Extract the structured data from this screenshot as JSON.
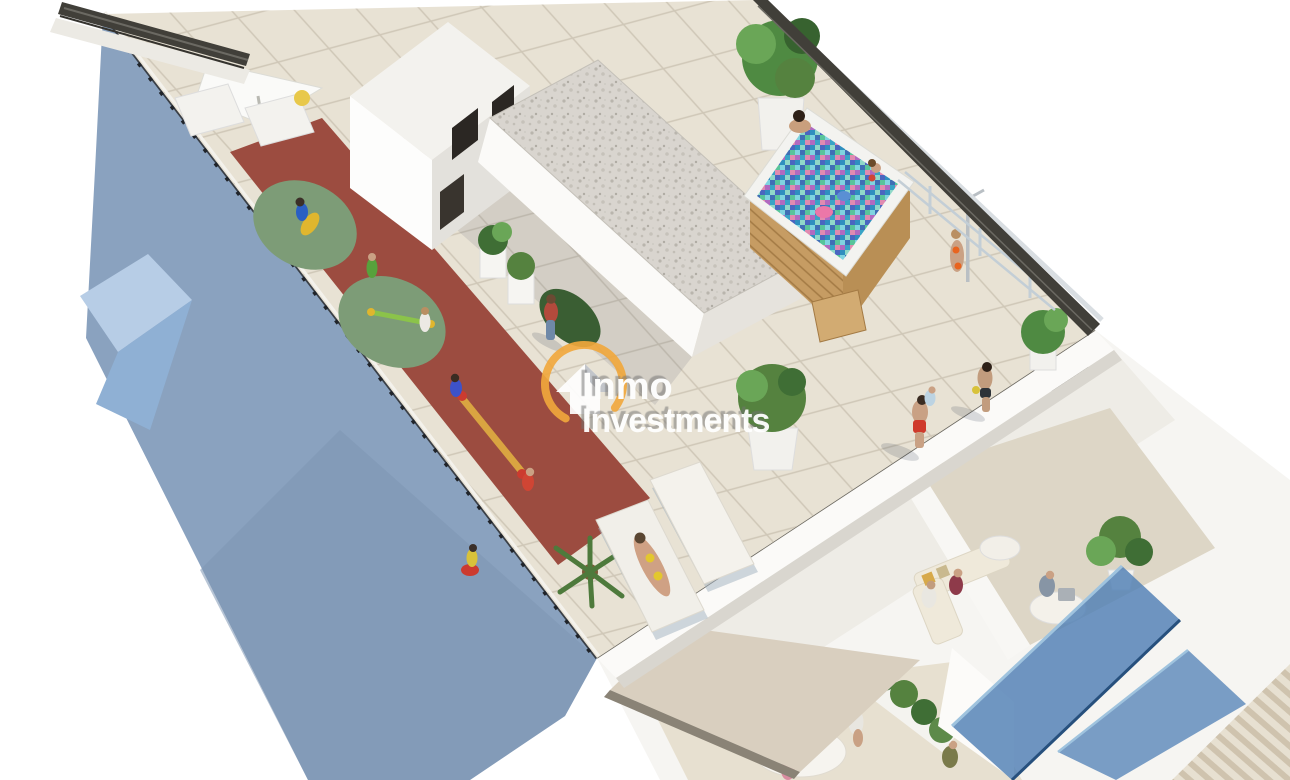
{
  "watermark": {
    "line1": "Inmo",
    "line2": "Investments",
    "ring_color": "#f0a83c",
    "text_color": "#ffffff"
  },
  "colors": {
    "background": "#ffffff",
    "facade": "#8aa2bf",
    "facade_light": "#b7cde6",
    "tile": "#e8e2d4",
    "grout": "#cfc7b7",
    "playground_red": "#9c4c40",
    "playground_green": "#7d9c77",
    "gravel": "#d9d5cf",
    "water": "#4ab0cf",
    "wood": "#c69c63",
    "awning": "#d9cfbf",
    "glass_railing": "#4f7fb5",
    "dark_railing": "#413f39",
    "parapet": "#fbfaf8",
    "plant": "#55823f",
    "neighbor_stripes": "#cfc3ae"
  },
  "scene": {
    "description": "Aerial 3D architectural render of an apartment building rooftop terrace, viewed diagonally from above on a white background.",
    "elements": [
      "tiled rooftop terrace",
      "blue side facade",
      "children playground strip with red rubber floor and green circles",
      "wooden jacuzzi with colorful mosaic water and bathers",
      "outdoor shower with bather",
      "sun loungers, sunbather and white parasol",
      "stair access housing with dark window openings",
      "gravel-covered roof block with planters",
      "potted plants and hedges",
      "lower floor terraces with sofas, table and people",
      "blue glass balcony balustrades",
      "retractable beige awning over lower terrace",
      "round terrace table with people",
      "neighboring striped roof corner"
    ]
  }
}
